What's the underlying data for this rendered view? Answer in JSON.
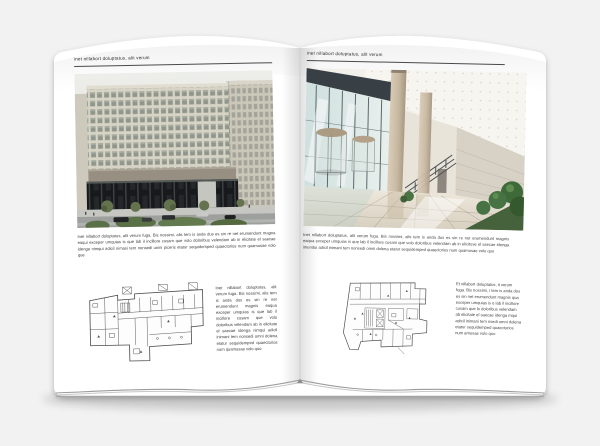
{
  "scene": {
    "background_color": "#f2f2f2",
    "paper_color": "#ffffff",
    "rule_color": "#4a4a4a"
  },
  "left_page": {
    "header": "inet nillabort doluptatus, alit verum",
    "body": "Inet nillabort doluptatus, alit verum fuga. Bis nossimi, alis tem is anda dus es sin re net erumendunt magna eaqui exceper umquias is que lab il incillore cusam que volo doloribus velendam ab in elicitate el saecae idenga nimqui adicil nimasi tem nonsedi unini piceris etatur sequidemped quaectorios num quamusae volo que",
    "plan_caption": "Inet nillabort doluptatus, alit verum fuga. Bis nossimi, alis tem is anda dus es sin re net erumendunt magnis eaqua exceper umquias is que lab il incillore cusam que volo doloribus velendam ab in elicitate el saecae idenga nimqui adicil inimani tem nonsedi omni dolena etatur sequidemped quaectorios num quamusae volo quo"
  },
  "right_page": {
    "header": "inet nillabort doluptatus, alit verum",
    "body": "Inet nillabort doluptatus, alit verum fuga. Bis nossimi, alis tem is anda dus es sin re net erumendunt magnis eaqua exceper umquias is que lab il incillore cusam que volo doloribus velendam ab in elicitose el saecae idenga imundui adicil inimani tem nonsedi omni dolena etatur sequidemped quaectorios num quamusae volo quo",
    "sidebar": "Et nillabort doluptatus, it verum fuga. Bis nossimi, i tem is anda dus es sin net erumendunt magnis qua exceper umquias is e lab il incillore cusam que lo doloribus velendam ab elicitate el saecae idenga mqui adicil inimani tem nsedi omni dolena etatur sequidemped quaectorios num amusae volo quo"
  }
}
